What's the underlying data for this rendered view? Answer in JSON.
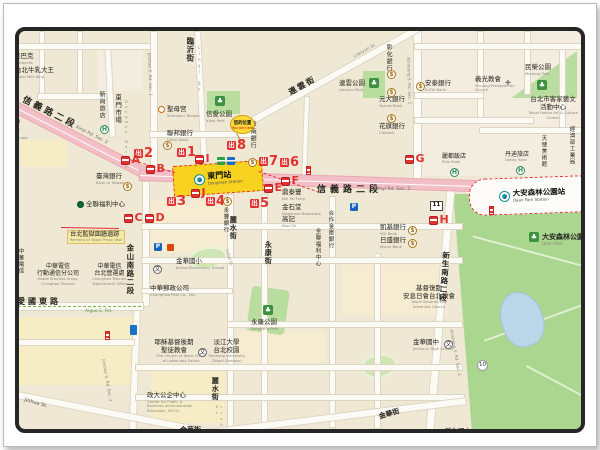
{
  "map": {
    "station": {
      "name": "東門站",
      "en": "Dongmen Station"
    },
    "daan_station": {
      "name": "大安森林公園站",
      "en": "Daan Park Station"
    },
    "you_are_here": {
      "label": "您的位置",
      "en": "You are here"
    },
    "accent_colors": {
      "exit_red": "#e23030",
      "station_yellow": "#f7d21e",
      "road_pink": "#f3bfc7",
      "park_green": "#abd68f"
    },
    "labels": [
      {
        "t": "星辰飯店",
        "e": "Chiuan Hotel",
        "x": 108,
        "y": 2,
        "s": 7
      },
      {
        "t": "星巴克",
        "e": "Starbucks",
        "x": 13,
        "y": 52,
        "s": 6.5
      },
      {
        "t": "台北牛乳大王",
        "e": "Taipei Milk King",
        "x": 14,
        "y": 66,
        "s": 6.5
      },
      {
        "t": "臨沂街",
        "x": 184,
        "y": 36,
        "s": 7.5,
        "v": 1,
        "b": 1
      },
      {
        "t": "Linyi St.",
        "x": 195,
        "y": 44,
        "s": 4,
        "v": 1,
        "c": "#8a877c"
      },
      {
        "t": "信義路二段",
        "x": 24,
        "y": 94,
        "s": 9,
        "b": 1,
        "r": 27,
        "ls": 3
      },
      {
        "t": "Xinyi Rd. Sec. 2",
        "x": 76,
        "y": 124,
        "s": 4.5,
        "r": 27,
        "c": "#6b675c"
      },
      {
        "t": "新尚旅店",
        "x": 97,
        "y": 90,
        "s": 6,
        "v": 1
      },
      {
        "t": "東門市場",
        "x": 112,
        "y": 93,
        "s": 6.5,
        "v": 1
      },
      {
        "t": "Dongmen Market",
        "x": 123,
        "y": 99,
        "s": 3.6,
        "v": 1,
        "c": "#8a877c"
      },
      {
        "t": "中",
        "x": 12,
        "y": 117,
        "s": 7,
        "b": 1
      },
      {
        "t": "(大)",
        "x": 8,
        "y": 126,
        "s": 6
      },
      {
        "t": "High School",
        "x": 4,
        "y": 135,
        "s": 3.8,
        "c": "#8a877c"
      },
      {
        "t": "聖母宮",
        "e": "Shengmu Temple",
        "x": 166,
        "y": 105,
        "s": 6.5
      },
      {
        "t": "信愛公園",
        "e": "Xinai Park",
        "x": 205,
        "y": 110,
        "s": 6.5
      },
      {
        "t": "連雲街",
        "x": 286,
        "y": 88,
        "s": 8,
        "b": 1,
        "r": -29,
        "ls": 2
      },
      {
        "t": "Lianyun St.",
        "x": 352,
        "y": 54,
        "s": 4.5,
        "r": -29,
        "c": "#8a877c"
      },
      {
        "t": "連雲公園",
        "e": "Lianyun Park",
        "x": 338,
        "y": 79,
        "s": 6.5
      },
      {
        "t": "民榮公園",
        "e": "Minrong Park",
        "x": 524,
        "y": 63,
        "s": 6.5
      },
      {
        "t": "彰化銀行",
        "x": 384,
        "y": 43,
        "s": 6,
        "v": 1
      },
      {
        "t": "元大銀行",
        "e": "Yuanta Bank",
        "x": 378,
        "y": 95,
        "s": 6.5
      },
      {
        "t": "花旗銀行",
        "e": "Citibank",
        "x": 378,
        "y": 122,
        "s": 6.5
      },
      {
        "t": "安泰銀行",
        "e": "EnTie Bank",
        "x": 424,
        "y": 79,
        "s": 6.5
      },
      {
        "t": "義光教會",
        "e": "Yikuang Presbyterian\nChurch",
        "x": 474,
        "y": 75,
        "s": 6.5
      },
      {
        "t": "台北市客家藝文\n活動中心",
        "e": "Taipei Hakka Art & Culture Center",
        "x": 521,
        "y": 95,
        "s": 6.5,
        "a": "c",
        "w": 62,
        "ew": 62
      },
      {
        "t": "經濟部工業局",
        "x": 567,
        "y": 125,
        "s": 5.5,
        "v": 1
      },
      {
        "t": "天使美術館",
        "x": 539,
        "y": 134,
        "s": 5.5,
        "v": 1
      },
      {
        "t": "丹迪旅店",
        "e": "Dandy Hotel",
        "x": 504,
        "y": 150,
        "s": 6
      },
      {
        "t": "麗都飯店",
        "e": "Rido Hotel",
        "x": 441,
        "y": 152,
        "s": 6
      },
      {
        "t": "Xinsheng S. Rd. Sec. 1",
        "x": 409,
        "y": 56,
        "s": 4.2,
        "r": 88,
        "c": "#8a877c"
      },
      {
        "t": "Jinshan S. Rd. Sec. 1",
        "x": 150,
        "y": 52,
        "s": 4.2,
        "r": 88,
        "c": "#8a877c"
      },
      {
        "t": "聯邦銀行",
        "e": "Union Bank",
        "x": 166,
        "y": 129,
        "s": 6.5
      },
      {
        "t": "華南銀行",
        "x": 248,
        "y": 120,
        "s": 6,
        "v": 1
      },
      {
        "t": "臺灣銀行",
        "e": "Bank of Taiwan",
        "x": 95,
        "y": 172,
        "s": 6.5
      },
      {
        "t": "信義路二段",
        "x": 316,
        "y": 184,
        "s": 9,
        "b": 1,
        "ls": 4
      },
      {
        "t": "Xinyi Rd. Sec. 2",
        "x": 374,
        "y": 186,
        "s": 4.5,
        "c": "#6b675c"
      },
      {
        "t": "鼎泰豐",
        "e": "Din Tai Fung",
        "x": 281,
        "y": 188,
        "s": 6.5
      },
      {
        "t": "金石堂",
        "e": "Kingstone Bookstore",
        "x": 281,
        "y": 203,
        "s": 6.5
      },
      {
        "t": "高記",
        "e": "Kao Chi",
        "x": 281,
        "y": 215,
        "s": 6.5
      },
      {
        "t": "永豐銀行",
        "x": 221,
        "y": 206,
        "s": 5.5,
        "v": 1
      },
      {
        "t": "麗水街",
        "x": 228,
        "y": 215,
        "s": 7,
        "v": 1,
        "b": 1
      },
      {
        "t": "Lishui St.",
        "x": 228,
        "y": 248,
        "s": 3.8,
        "r": 75,
        "c": "#8a877c"
      },
      {
        "t": "永康街",
        "x": 263,
        "y": 240,
        "s": 7,
        "v": 1,
        "b": 1
      },
      {
        "t": "合作金庫銀行",
        "x": 326,
        "y": 209,
        "s": 5.5,
        "v": 1
      },
      {
        "t": "全聯福利中心",
        "x": 313,
        "y": 227,
        "s": 5.5,
        "v": 1
      },
      {
        "t": "凱基銀行",
        "e": "KGI Bank",
        "x": 379,
        "y": 223,
        "s": 6.5
      },
      {
        "t": "日盛銀行",
        "e": "Jihsun Bank",
        "x": 379,
        "y": 236,
        "s": 6.5
      },
      {
        "t": "全聯福利中心",
        "x": 85,
        "y": 200,
        "s": 6.5
      },
      {
        "t": "台北監獄圍牆遺跡",
        "e": "Remains of Taipei Prison Wall",
        "x": 66,
        "y": 229,
        "s": 6.2,
        "bg": "#f7e9a8"
      },
      {
        "t": "中華電信",
        "x": 16,
        "y": 247,
        "s": 5.5,
        "v": 1
      },
      {
        "t": "國際分公司",
        "x": 6,
        "y": 247,
        "s": 5.5,
        "v": 1
      },
      {
        "t": "中華電信\n行動通信分公司",
        "e": "Mobile Business Group,\nChunghwa Telecom",
        "x": 36,
        "y": 262,
        "s": 6,
        "a": "c"
      },
      {
        "t": "中華電信\n台北營運處",
        "e": "Chunghwa Telecom\nTaipei Branch Office",
        "x": 91,
        "y": 262,
        "s": 6,
        "a": "c"
      },
      {
        "t": "愛國東路",
        "x": 16,
        "y": 296,
        "s": 8,
        "b": 1,
        "ls": 3
      },
      {
        "t": "Aiguo E. Rd.",
        "x": 84,
        "y": 308,
        "s": 4.5,
        "c": "#5a9a3c"
      },
      {
        "t": "金山南路二段",
        "x": 124,
        "y": 243,
        "s": 7.5,
        "v": 1,
        "b": 1
      },
      {
        "t": "Jinshan S. Rd. Sec. 2",
        "x": 104,
        "y": 358,
        "s": 4.2,
        "r": 80,
        "c": "#8a877c"
      },
      {
        "t": "金華國小",
        "e": "Jinhua Elementary School",
        "x": 175,
        "y": 257,
        "s": 6.5
      },
      {
        "t": "中華郵政公司",
        "e": "Chunghwa Post Co., Ltd.",
        "x": 149,
        "y": 284,
        "s": 6.5
      },
      {
        "t": "永康公園",
        "e": "Yongkang Park",
        "x": 250,
        "y": 318,
        "s": 6.5
      },
      {
        "t": "基督復臨\n安息日會台北教會",
        "e": "Taipei Seventh-day\nAdventist Church",
        "x": 396,
        "y": 284,
        "s": 6.5,
        "a": "c",
        "w": 64,
        "ew": 64
      },
      {
        "t": "金華國中",
        "e": "Jinhua Jr. High School",
        "x": 412,
        "y": 338,
        "s": 6.5
      },
      {
        "t": "新生南路二段",
        "x": 440,
        "y": 250,
        "s": 7.5,
        "v": 1,
        "b": 1,
        "r": 4
      },
      {
        "t": "Xinsheng S. Rd. Sec. 2",
        "x": 452,
        "y": 328,
        "s": 4.2,
        "r": 80,
        "c": "#8a877c"
      },
      {
        "t": "大安森林公園",
        "e": "Daan Park",
        "x": 541,
        "y": 232,
        "s": 7,
        "b": 1
      },
      {
        "t": "耶穌基督後期\n聖徒教會",
        "e": "The Church of Jesus Christ\nof Latter-day Saints",
        "x": 150,
        "y": 338,
        "s": 6.5,
        "a": "c",
        "w": 46,
        "ew": 60
      },
      {
        "t": "淡江大學\n台北校園",
        "e": "Tamkang University\n(Taipei Campus)",
        "x": 207,
        "y": 338,
        "s": 6.5,
        "a": "c"
      },
      {
        "t": "政大公企中心",
        "e": "Center for Public &\nBusiness Administration\nEducation, NCCU",
        "x": 146,
        "y": 391,
        "s": 6.5
      },
      {
        "t": "Jinhua St.",
        "x": 24,
        "y": 397,
        "s": 5,
        "r": 16,
        "c": "#55524a"
      },
      {
        "t": "麗水街",
        "x": 210,
        "y": 376,
        "s": 7,
        "v": 1,
        "b": 1
      },
      {
        "t": "Lishui St.",
        "x": 213,
        "y": 403,
        "s": 3.8,
        "v": 1,
        "c": "#8a877c"
      },
      {
        "t": "金華街",
        "x": 179,
        "y": 425,
        "s": 7,
        "b": 1
      },
      {
        "t": "金華街",
        "x": 377,
        "y": 412,
        "s": 7,
        "b": 1,
        "r": -16
      },
      {
        "t": "新生國小",
        "x": 444,
        "y": 427,
        "s": 6.5
      }
    ],
    "exits": [
      {
        "n": "2",
        "x": 133,
        "y": 147
      },
      {
        "n": "1",
        "x": 176,
        "y": 146
      },
      {
        "n": "8",
        "x": 226,
        "y": 139
      },
      {
        "n": "7",
        "x": 258,
        "y": 155
      },
      {
        "n": "6",
        "x": 279,
        "y": 156
      },
      {
        "n": "5",
        "x": 249,
        "y": 197
      },
      {
        "n": "4",
        "x": 205,
        "y": 195
      },
      {
        "n": "3",
        "x": 166,
        "y": 195
      }
    ],
    "buses": [
      {
        "l": "A",
        "x": 120,
        "y": 154
      },
      {
        "l": "B",
        "x": 145,
        "y": 163
      },
      {
        "l": "I",
        "x": 194,
        "y": 153
      },
      {
        "l": "J",
        "x": 190,
        "y": 187
      },
      {
        "l": "C",
        "x": 123,
        "y": 212
      },
      {
        "l": "D",
        "x": 144,
        "y": 212
      },
      {
        "l": "E",
        "x": 263,
        "y": 182
      },
      {
        "l": "F",
        "x": 280,
        "y": 175
      },
      {
        "l": "G",
        "x": 404,
        "y": 153
      },
      {
        "l": "H",
        "x": 428,
        "y": 214
      }
    ],
    "icons": [
      {
        "k": "hotel",
        "t": "H",
        "x": 150,
        "y": 11
      },
      {
        "k": "hotel",
        "t": "H",
        "x": 99,
        "y": 124
      },
      {
        "k": "hotel",
        "t": "H",
        "x": 449,
        "y": 167
      },
      {
        "k": "hotel",
        "t": "H",
        "x": 515,
        "y": 165
      },
      {
        "k": "park",
        "t": "♣",
        "x": 214,
        "y": 95
      },
      {
        "k": "park",
        "t": "♣",
        "x": 368,
        "y": 77
      },
      {
        "k": "park",
        "t": "♣",
        "x": 536,
        "y": 79
      },
      {
        "k": "park",
        "t": "♣",
        "x": 262,
        "y": 304
      },
      {
        "k": "park",
        "t": "♣",
        "x": 528,
        "y": 231
      },
      {
        "k": "bank",
        "t": "$",
        "x": 162,
        "y": 140
      },
      {
        "k": "bank",
        "t": "$",
        "x": 122,
        "y": 181
      },
      {
        "k": "bank",
        "t": "$",
        "x": 247,
        "y": 157
      },
      {
        "k": "bank",
        "t": "$",
        "x": 222,
        "y": 196
      },
      {
        "k": "bank",
        "t": "$",
        "x": 386,
        "y": 69
      },
      {
        "k": "bank",
        "t": "$",
        "x": 386,
        "y": 87
      },
      {
        "k": "bank",
        "t": "$",
        "x": 386,
        "y": 113
      },
      {
        "k": "bank",
        "t": "$",
        "x": 415,
        "y": 81
      },
      {
        "k": "bank",
        "t": "$",
        "x": 407,
        "y": 225
      },
      {
        "k": "bank",
        "t": "$",
        "x": 407,
        "y": 238
      },
      {
        "k": "school",
        "t": "文",
        "x": 152,
        "y": 264
      },
      {
        "k": "school",
        "t": "文",
        "x": 197,
        "y": 347
      },
      {
        "k": "school",
        "t": "文",
        "x": 443,
        "y": 339
      },
      {
        "k": "church",
        "t": "✚",
        "x": 504,
        "y": 79
      },
      {
        "k": "temple",
        "t": "",
        "x": 157,
        "y": 105
      },
      {
        "k": "parking",
        "t": "P",
        "x": 349,
        "y": 202
      },
      {
        "k": "parking",
        "t": "P",
        "x": 153,
        "y": 242
      },
      {
        "k": "postbox",
        "t": "",
        "x": 216,
        "y": 156
      },
      {
        "k": "police",
        "t": "",
        "x": 226,
        "y": 156
      },
      {
        "k": "shop",
        "t": "",
        "x": 166,
        "y": 243
      },
      {
        "k": "bluebox",
        "t": "",
        "x": 129,
        "y": 324
      },
      {
        "k": "stripe",
        "t": "",
        "x": 104,
        "y": 330
      },
      {
        "k": "stripe",
        "t": "",
        "x": 488,
        "y": 205
      },
      {
        "k": "stripe",
        "t": "",
        "x": 305,
        "y": 165
      },
      {
        "k": "plate",
        "t": "11",
        "x": 429,
        "y": 200
      },
      {
        "k": "circle",
        "t": "10",
        "x": 476,
        "y": 359
      },
      {
        "k": "logo-g",
        "t": "",
        "x": 3,
        "y": 53
      },
      {
        "k": "logo-o",
        "t": "",
        "x": 4,
        "y": 66
      },
      {
        "k": "logo-g",
        "t": "",
        "x": 76,
        "y": 200
      }
    ]
  }
}
